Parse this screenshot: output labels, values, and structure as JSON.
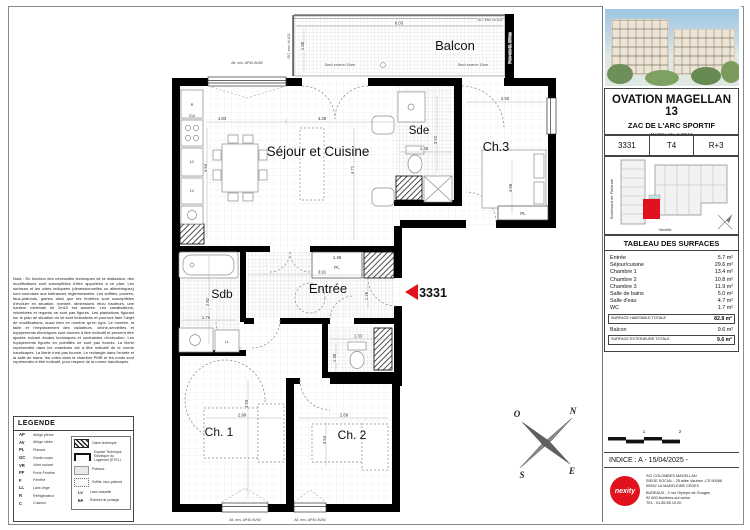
{
  "plan": {
    "unit_marker": "3331",
    "rooms": {
      "balcon": "Balcon",
      "sejour": "Séjour et Cuisine",
      "sde": "Sde",
      "ch3": "Ch.3",
      "sdb": "Sdb",
      "entree": "Entrée",
      "ch1": "Ch. 1",
      "ch2": "Ch. 2",
      "pl": "PL"
    },
    "appliances": {
      "cui": "CUI",
      "lc": "LC",
      "lv": "LV",
      "ll": "LL",
      "r": "R"
    },
    "dims": {
      "balcon_w": "8.03",
      "balcon_h": "1.60",
      "kitchen_w": "1.83",
      "kitchen_h": "4.54",
      "sejour_w": "4.39",
      "sejour_h": "4.71",
      "sde_w": "1.48",
      "sde_h": "3.52",
      "ch3_w": "2.50",
      "ch3_h": "4.56",
      "pl_w": "1.48",
      "entree_w": "3.91",
      "hall_h": "1.26",
      "sdb_h": "2.82",
      "sdb_w": "1.76",
      "wc_w": "1.33",
      "wc_h": "1.30",
      "ch1_w": "2.99",
      "ch1_h": "4.93",
      "ch2_w": "2.69",
      "ch2_h": "3.54"
    },
    "annotations": {
      "window_sill": "All. env. AP40 AV60",
      "seuil": "Seuil environ 15cm",
      "gc": "GC: env. ht.102",
      "pare_vue": "Pare-vue ht. 180cm"
    },
    "compass": {
      "n": "N",
      "s": "S",
      "e": "E",
      "o": "O"
    }
  },
  "notes": {
    "text": "Nota : En fonction des nécessités techniques de la réalisation, des modifications sont susceptibles d'être apportées à ce plan. Les surfaces et les côtes indiquées (dimensionnelles ou altimétriques) sont soumises aux tolérances réglementaires. Les soffites, poutres, faux-plafonds, gaines ainsi que les fenêtres sont susceptibles d'évoluer en situation, nombre, dimensions et/ou hauteurs, une hauteur minimale de 2m10 est assurée. Les canalisations, retombées et regards ne sont pas figurés. Les plantations figurant sur le plan de situation du lot sont indicatives et pourront faire l'objet de modifications, aussi bien en nombre qu'en type. Le nombre, la taille et l'emplacement des radiateurs, sèche-serviettes et équipements électriques sont donnés à titre indicatif et peuvent être ajustés suivant études techniques et contraintes d'exécution. Les équipements figurés en pointillés ne sont pas fournis. La literie représentée dans les chambres est à titre indicatif de la norme handicapés. La literie n'est pas fournie. Le rectangle dans l'entrée et la salle de bains, les côtes dans la chambre PMR et les ronds sont représentés à titre indicatif, pour respect de la norme handicapés."
  },
  "legend": {
    "title": "LEGENDE",
    "abbr_items": [
      {
        "abbr": "AP",
        "label": "Allège pleine"
      },
      {
        "abbr": "AV",
        "label": "Allège vitrée"
      },
      {
        "abbr": "PL",
        "label": "Placard"
      },
      {
        "abbr": "GC",
        "label": "Garde-corps"
      },
      {
        "abbr": "VR",
        "label": "Volet roulant"
      },
      {
        "abbr": "PF",
        "label": "Porte Fenêtre"
      },
      {
        "abbr": "F",
        "label": "Fenêtre"
      },
      {
        "abbr": "LL",
        "label": "Lave-linge"
      },
      {
        "abbr": "R",
        "label": "Réfrigérateur"
      },
      {
        "abbr": "C",
        "label": "Cuisson"
      }
    ],
    "symbol_items": [
      {
        "label": "Gaine technique"
      },
      {
        "label": "Espace Technique Electrique du Logement (ETEL)"
      },
      {
        "label": "Poteaux"
      },
      {
        "label": "Soffite, faux-plafond"
      }
    ],
    "abbr_items2": [
      {
        "abbr": "LV",
        "label": "Lave vaisselle"
      },
      {
        "abbr": "RP",
        "label": "Robinet de puisage"
      }
    ]
  },
  "panel": {
    "project_title": "OVATION MAGELLAN 13",
    "project_subtitle": "ZAC DE L'ARC SPORTIF",
    "project_line3": "MAGELLAN - ILOT 13",
    "project_line4": "92700- COLOMBES",
    "lot_number": "3331",
    "lot_type": "T4",
    "lot_floor": "R+3",
    "keyplan": {
      "street_left": "Boulevard de Finlande",
      "street_bottom": "Venelle"
    },
    "surfaces": {
      "title": "TABLEAU DES SURFACES",
      "rows": [
        {
          "label": "Entrée",
          "value": "5.7 m²"
        },
        {
          "label": "Séjour/cuisine",
          "value": "29.6 m²"
        },
        {
          "label": "Chambre 1",
          "value": "13.4 m²"
        },
        {
          "label": "Chambre 2",
          "value": "10.8 m²"
        },
        {
          "label": "Chambre 3",
          "value": "11.9 m²"
        },
        {
          "label": "Salle de bains",
          "value": "5.0 m²"
        },
        {
          "label": "Salle d'eau",
          "value": "4.7 m²"
        },
        {
          "label": "WC",
          "value": "1.7 m²"
        }
      ],
      "total_label": "SURFACE HABITABLE TOTALE",
      "total_value": "82.8 m²",
      "balcony_label": "Balcon",
      "balcony_value": "9.6 m²",
      "ext_total_label": "SURFACE EXTERIEURE TOTALE",
      "ext_total_value": "9.6 m²"
    },
    "scalebar": {
      "t1": "1",
      "t2": "2"
    },
    "indice": "INDICE : A - 15/04/2025 -",
    "company": {
      "logo": "nexity",
      "lines1": [
        "SCI COLOMBES MAGELLAN",
        "SIEGE SOCIAL : 25 allée Vauban -CS 50068",
        "59262 LA MADELEINE CEDEX"
      ],
      "lines2": [
        "BUREAUX : 2 rue Olympe de Gouges",
        "92 600 Asnières-sur-seine",
        "TEL : 01.85.55.10.00"
      ]
    }
  }
}
